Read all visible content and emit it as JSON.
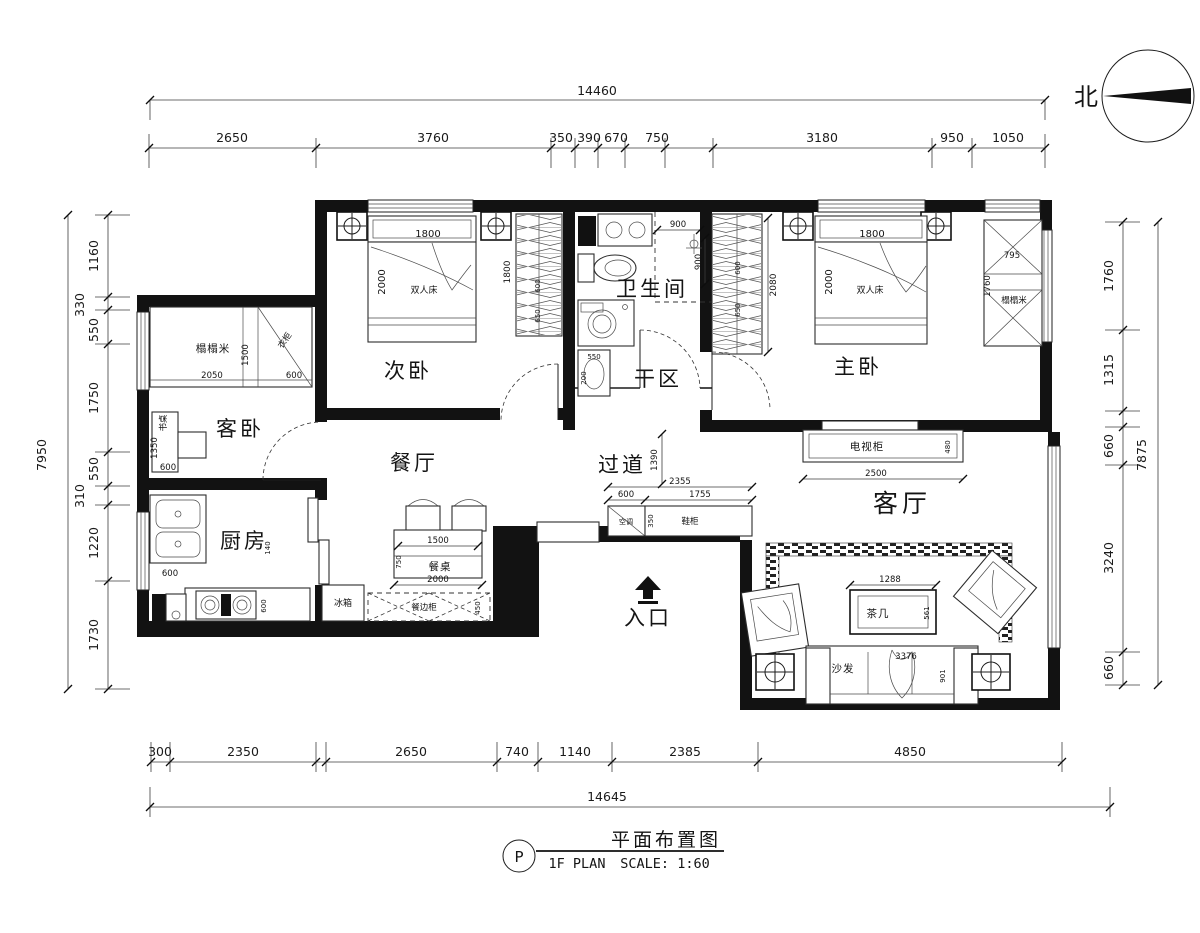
{
  "drawing": {
    "north_label": "北",
    "title_block": {
      "ref_letter": "P",
      "plan_code": "1F  PLAN",
      "title": "平面布置图",
      "scale": "SCALE: 1:60"
    },
    "rooms": {
      "second_bedroom": "次卧",
      "bathroom": "卫生间",
      "dry_area": "干区",
      "master_bedroom": "主卧",
      "guest_bedroom": "客卧",
      "dining_room": "餐厅",
      "corridor": "过道",
      "living_room": "客厅",
      "kitchen": "厨房",
      "entrance": "入口"
    },
    "furniture": {
      "double_bed": "双人床",
      "tatami": "榻榻米",
      "desk": "书桌",
      "wardrobe": "衣柜",
      "tv_cabinet": "电视柜",
      "tea_table": "茶几",
      "sofa": "沙发",
      "dining_table": "餐桌",
      "fridge": "冰箱",
      "shoe_cabinet": "鞋柜",
      "sideboard": "餐边柜",
      "ac_unit": "空调"
    },
    "dims": {
      "top_total": "14460",
      "top": [
        "2650",
        "3760",
        "350",
        "390",
        "670",
        "750",
        "3180",
        "950",
        "1050"
      ],
      "bottom": [
        "300",
        "2350",
        "2650",
        "740",
        "1140",
        "2385",
        "4850"
      ],
      "bottom_total": "14645",
      "left_total": "7950",
      "left": [
        "1160",
        "330",
        "550",
        "1750",
        "550",
        "310",
        "1220",
        "1730"
      ],
      "right": [
        "1760",
        "1315",
        "660",
        "3240",
        "660"
      ],
      "right_total": "7875"
    },
    "inner_dims": {
      "bed_width": "1800",
      "bed_depth": "2000",
      "second_wardrobe_h": "1800",
      "second_wardrobe_a": "600",
      "second_wardrobe_b": "650",
      "master_wardrobe_h": "2080",
      "master_wardrobe_a": "600",
      "master_wardrobe_b": "650",
      "master_tatami_w": "795",
      "master_tatami_h": "1760",
      "guest_tatami_w": "2050",
      "guest_tatami_h": "1500",
      "guest_side": "600",
      "desk_h": "1350",
      "desk_w": "600",
      "shower_w": "900",
      "shower_d": "900",
      "dry_basin_w": "550",
      "dry_basin_d": "200",
      "kitchen_counter": "600",
      "kitchen_side": "600",
      "kitchen_gap": "140",
      "tv_w": "2500",
      "tv_d": "480",
      "tea_w": "1288",
      "tea_d": "561",
      "sofa_w": "3376",
      "sofa_d": "901",
      "table_w": "1500",
      "table_d": "750",
      "table_total": "2000",
      "shoe_d": "450",
      "corridor_total": "2355",
      "corridor_a": "600",
      "corridor_b": "1755",
      "corridor_c": "1390",
      "corridor_cab": "350"
    }
  }
}
